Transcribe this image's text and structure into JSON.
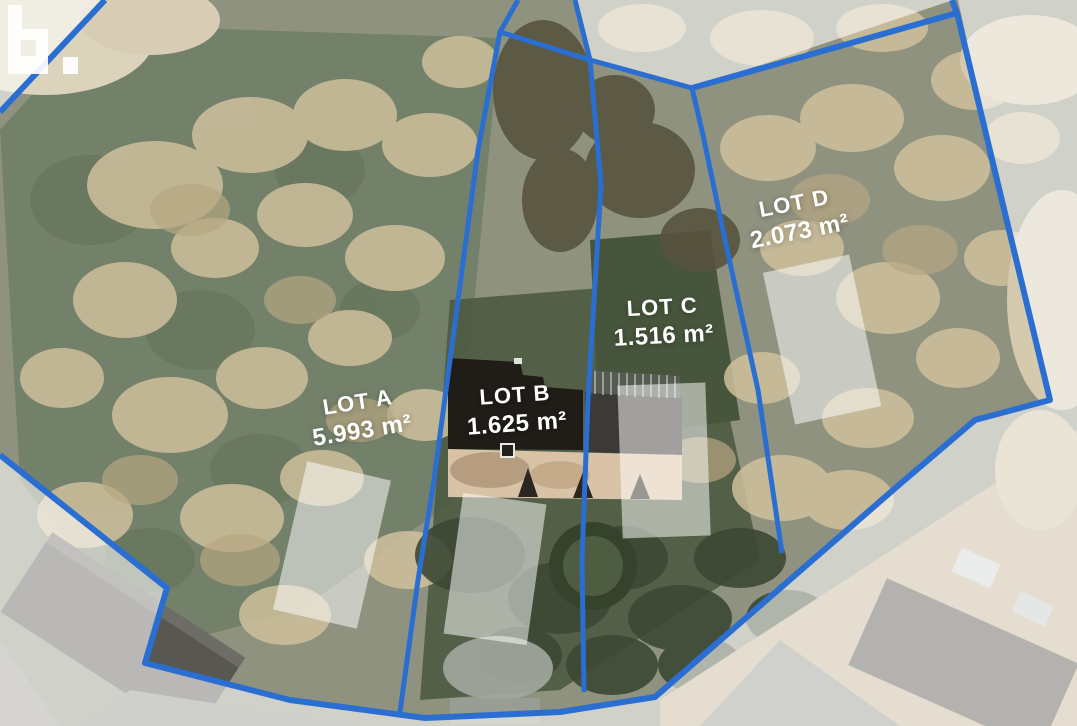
{
  "map": {
    "title": "aerial lot plan",
    "lots": [
      {
        "name": "LOT A",
        "area": "5.993 m²"
      },
      {
        "name": "LOT B",
        "area": "1.625 m²"
      },
      {
        "name": "LOT C",
        "area": "1.516 m²"
      },
      {
        "name": "LOT D",
        "area": "2.073 m²"
      }
    ],
    "logo_text": "b.",
    "colors": {
      "boundary": "#2b6ed2",
      "label": "#ffffff",
      "footprint_fill": "rgba(255,255,255,0.52)"
    }
  }
}
